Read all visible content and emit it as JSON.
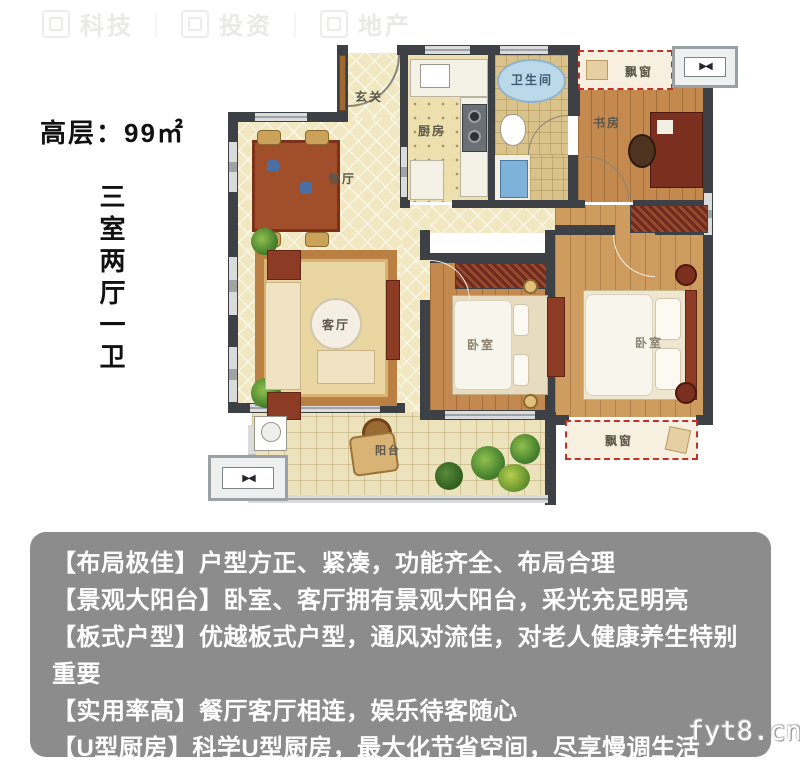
{
  "header": {
    "area_label": "高层：99㎡"
  },
  "side_label": {
    "text": "三室两厅一卫"
  },
  "watermark_top": {
    "groups": [
      "科技",
      "投资",
      "地产"
    ],
    "separator": "｜"
  },
  "watermark_bottom": {
    "text": "fyt8.cn"
  },
  "floorplan": {
    "rooms": {
      "entry": "玄关",
      "dining": "餐厅",
      "kitchen": "厨房",
      "bathroom": "卫生间",
      "study": "书房",
      "living": "客厅",
      "bedroom_middle": "卧室",
      "bedroom_right": "卧室",
      "balcony": "阳台",
      "bay_window_top": "飘窗",
      "bay_window_bottom": "飘窗"
    },
    "icons": {
      "fan": "▶◀"
    }
  },
  "features": {
    "lines": [
      "【布局极佳】户型方正、紧凑，功能齐全、布局合理",
      "【景观大阳台】卧室、客厅拥有景观大阳台，采光充足明亮",
      "【板式户型】优越板式户型，通风对流佳，对老人健康养生特别重要",
      "【实用率高】餐厅客厅相连，娱乐待客随心",
      "【U型厨房】科学U型厨房，最大化节省空间，尽享慢调生活"
    ]
  },
  "colors": {
    "wall": "#3d4145",
    "accent_red": "#c03127",
    "panel_gray": "#8c8c8c"
  }
}
